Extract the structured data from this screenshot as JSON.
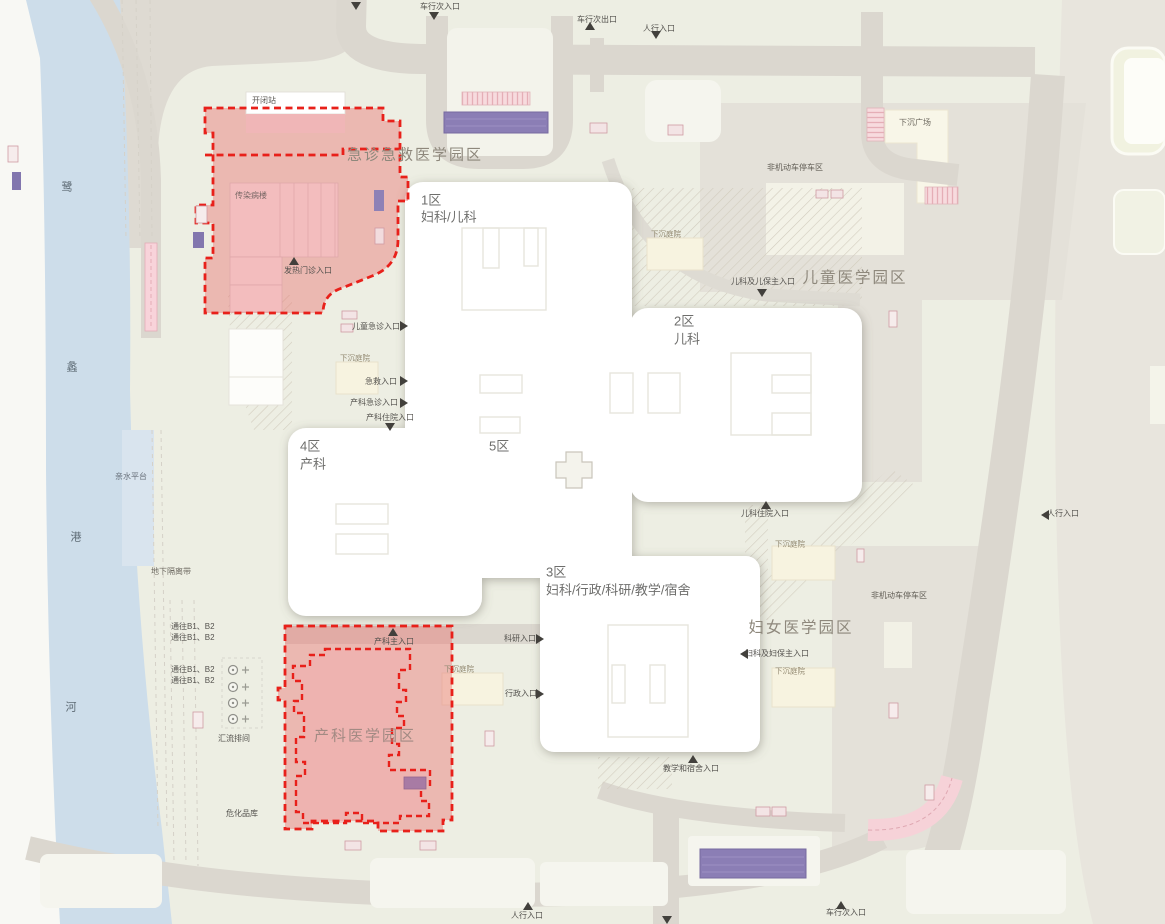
{
  "page": {
    "width": 1165,
    "height": 924,
    "type": "hospital-campus-site-plan"
  },
  "colors": {
    "site_ground": "#edeee3",
    "offsite": "#e8e5dd",
    "road": "#dbd7cf",
    "river": "#cdddea",
    "west_bank": "#f8f8f4",
    "red_zone_fill": "#e96e6c",
    "red_dash": "#e8201a",
    "building_white": "#ffffff",
    "pink_building": "#f3bdbe",
    "purple_ramp": "#8b7eb5",
    "parking": "#e4e1d9",
    "courtyard_box": "#f7f3e0",
    "crosswalk_pink": "#f7dbde"
  },
  "map": {
    "river_name": "鹭蠡港河",
    "campuses": [
      "急诊急救医学园区",
      "儿童医学园区",
      "妇女医学园区",
      "产科医学园区"
    ],
    "districts": [
      {
        "id": "1区",
        "dept": "妇科/儿科"
      },
      {
        "id": "2区",
        "dept": "儿科"
      },
      {
        "id": "3区",
        "dept": "妇科/行政/科研/教学/宿舍"
      },
      {
        "id": "4区",
        "dept": "产科"
      },
      {
        "id": "5区",
        "dept": ""
      }
    ],
    "labels": [
      {
        "n": "label-vehicle-entry-top",
        "t": "车行次入口",
        "x": 440,
        "y": 7,
        "a": "c",
        "s": 8
      },
      {
        "n": "label-vehicle-exit-top",
        "t": "车行次出口",
        "x": 597,
        "y": 20,
        "a": "c",
        "s": 8
      },
      {
        "n": "label-pedestrian-entry-top",
        "t": "人行入口",
        "x": 659,
        "y": 29,
        "a": "c",
        "s": 8
      },
      {
        "n": "label-campus-emergency",
        "t": "急诊急救医学园区",
        "x": 415,
        "y": 155,
        "a": "c",
        "s": 15,
        "c": "#8e887c",
        "ls": 2
      },
      {
        "n": "label-switch-station",
        "t": "开闭站",
        "x": 252,
        "y": 101,
        "a": "l",
        "s": 8,
        "c": "#5c5a56"
      },
      {
        "n": "label-infectious-building",
        "t": "传染病楼",
        "x": 235,
        "y": 196,
        "a": "l",
        "s": 8,
        "c": "#786765"
      },
      {
        "n": "label-fever-clinic-entry",
        "t": "发热门诊入口",
        "x": 308,
        "y": 271,
        "a": "c",
        "s": 8
      },
      {
        "n": "label-district1-no",
        "t": "1区",
        "x": 421,
        "y": 200,
        "a": "l",
        "s": 13,
        "c": "#6e6e6c"
      },
      {
        "n": "label-district1-dept",
        "t": "妇科/儿科",
        "x": 421,
        "y": 217,
        "a": "l",
        "s": 13,
        "c": "#6e6e6c"
      },
      {
        "n": "label-district2-no",
        "t": "2区",
        "x": 674,
        "y": 321,
        "a": "l",
        "s": 13,
        "c": "#6e6e6c"
      },
      {
        "n": "label-district2-dept",
        "t": "儿科",
        "x": 674,
        "y": 339,
        "a": "l",
        "s": 13,
        "c": "#6e6e6c"
      },
      {
        "n": "label-campus-children",
        "t": "儿童医学园区",
        "x": 855,
        "y": 278,
        "a": "c",
        "s": 15.5,
        "c": "#8e887c",
        "ls": 2
      },
      {
        "n": "label-pediatrics-main-entry",
        "t": "儿科及儿保主入口",
        "x": 763,
        "y": 282,
        "a": "c",
        "s": 8
      },
      {
        "n": "label-sunken-courtyard-ne",
        "t": "下沉庭院",
        "x": 651,
        "y": 234,
        "a": "l",
        "s": 7.5,
        "c": "#938a72"
      },
      {
        "n": "label-sunken-plaza",
        "t": "下沉广场",
        "x": 915,
        "y": 123,
        "a": "c",
        "s": 8,
        "c": "#6e6a60"
      },
      {
        "n": "label-parking-top",
        "t": "非机动车停车区",
        "x": 795,
        "y": 168,
        "a": "c",
        "s": 8,
        "c": "#615d55"
      },
      {
        "n": "label-children-emergency-entry",
        "t": "儿童急诊入口",
        "x": 376,
        "y": 327,
        "a": "c",
        "s": 8
      },
      {
        "n": "label-sunken-courtyard-w",
        "t": "下沉庭院",
        "x": 340,
        "y": 358,
        "a": "l",
        "s": 7.5,
        "c": "#938a72"
      },
      {
        "n": "label-rescue-entry",
        "t": "急救入口",
        "x": 381,
        "y": 382,
        "a": "c",
        "s": 8
      },
      {
        "n": "label-obstetrics-emergency-entry",
        "t": "产科急诊入口",
        "x": 374,
        "y": 403,
        "a": "c",
        "s": 8
      },
      {
        "n": "label-obstetrics-inpatient-entry",
        "t": "产科住院入口",
        "x": 390,
        "y": 418,
        "a": "c",
        "s": 8
      },
      {
        "n": "label-district4-no",
        "t": "4区",
        "x": 300,
        "y": 446,
        "a": "l",
        "s": 13,
        "c": "#6e6e6c"
      },
      {
        "n": "label-district4-dept",
        "t": "产科",
        "x": 300,
        "y": 464,
        "a": "l",
        "s": 13,
        "c": "#6e6e6c"
      },
      {
        "n": "label-district5-no",
        "t": "5区",
        "x": 489,
        "y": 446,
        "a": "l",
        "s": 13,
        "c": "#6e6e6c"
      },
      {
        "n": "label-waterfront-platform",
        "t": "亲水平台",
        "x": 131,
        "y": 477,
        "a": "c",
        "s": 8,
        "c": "#68707a"
      },
      {
        "n": "label-underground-isolation",
        "t": "地下隔离带",
        "x": 171,
        "y": 572,
        "a": "c",
        "s": 8,
        "c": "#6e6a62"
      },
      {
        "n": "label-to-b1b2-1",
        "t": "通往B1、B2",
        "x": 171,
        "y": 627,
        "a": "l",
        "s": 8
      },
      {
        "n": "label-to-b1b2-2",
        "t": "通往B1、B2",
        "x": 171,
        "y": 638,
        "a": "l",
        "s": 8
      },
      {
        "n": "label-to-b1b2-3",
        "t": "通往B1、B2",
        "x": 171,
        "y": 670,
        "a": "l",
        "s": 8
      },
      {
        "n": "label-to-b1b2-4",
        "t": "通往B1、B2",
        "x": 171,
        "y": 681,
        "a": "l",
        "s": 8
      },
      {
        "n": "label-busbar-room",
        "t": "汇流排间",
        "x": 234,
        "y": 739,
        "a": "c",
        "s": 8
      },
      {
        "n": "label-hazmat-warehouse",
        "t": "危化品库",
        "x": 242,
        "y": 814,
        "a": "c",
        "s": 8
      },
      {
        "n": "label-district3-no",
        "t": "3区",
        "x": 546,
        "y": 572,
        "a": "l",
        "s": 13,
        "c": "#6e6e6c"
      },
      {
        "n": "label-district3-dept",
        "t": "妇科/行政/科研/教学/宿舍",
        "x": 546,
        "y": 590,
        "a": "l",
        "s": 13,
        "c": "#6e6e6c"
      },
      {
        "n": "label-research-entry",
        "t": "科研入口",
        "x": 520,
        "y": 639,
        "a": "c",
        "s": 8
      },
      {
        "n": "label-admin-entry",
        "t": "行政入口",
        "x": 521,
        "y": 694,
        "a": "c",
        "s": 8
      },
      {
        "n": "label-obstetrics-main-entry",
        "t": "产科主入口",
        "x": 394,
        "y": 642,
        "a": "c",
        "s": 8
      },
      {
        "n": "label-sunken-courtyard-s",
        "t": "下沉庭院",
        "x": 444,
        "y": 669,
        "a": "l",
        "s": 7.5,
        "c": "#938a72"
      },
      {
        "n": "label-campus-obstetrics",
        "t": "产科医学园区",
        "x": 365,
        "y": 736,
        "a": "c",
        "s": 15,
        "c": "#a28a83",
        "ls": 2
      },
      {
        "n": "label-campus-women",
        "t": "妇女医学园区",
        "x": 801,
        "y": 628,
        "a": "c",
        "s": 15.5,
        "c": "#8e887c",
        "ls": 2
      },
      {
        "n": "label-gyn-main-entry",
        "t": "妇科及妇保主入口",
        "x": 777,
        "y": 654,
        "a": "c",
        "s": 8
      },
      {
        "n": "label-sunken-courtyard-e1",
        "t": "下沉庭院",
        "x": 775,
        "y": 544,
        "a": "l",
        "s": 7.5,
        "c": "#938a72"
      },
      {
        "n": "label-sunken-courtyard-e2",
        "t": "下沉庭院",
        "x": 775,
        "y": 671,
        "a": "l",
        "s": 7.5,
        "c": "#938a72"
      },
      {
        "n": "label-pediatric-inpatient-entry",
        "t": "儿科住院入口",
        "x": 765,
        "y": 514,
        "a": "c",
        "s": 8
      },
      {
        "n": "label-parking-right",
        "t": "非机动车停车区",
        "x": 899,
        "y": 596,
        "a": "c",
        "s": 8,
        "c": "#615d55"
      },
      {
        "n": "label-pedestrian-entry-right",
        "t": "人行入口",
        "x": 1063,
        "y": 514,
        "a": "c",
        "s": 8
      },
      {
        "n": "label-teaching-dorm-entry",
        "t": "教学和宿舍入口",
        "x": 691,
        "y": 769,
        "a": "c",
        "s": 8
      },
      {
        "n": "label-pedestrian-entry-bottom",
        "t": "人行入口",
        "x": 527,
        "y": 916,
        "a": "c",
        "s": 8
      },
      {
        "n": "label-vehicle-entry-bottom",
        "t": "车行次入口",
        "x": 846,
        "y": 913,
        "a": "c",
        "s": 8
      },
      {
        "n": "label-river-char-1",
        "t": "鹭",
        "x": 67,
        "y": 188,
        "a": "c",
        "s": 11,
        "c": "#5d6a74"
      },
      {
        "n": "label-river-char-2",
        "t": "蠡",
        "x": 72,
        "y": 368,
        "a": "c",
        "s": 11,
        "c": "#5d6a74"
      },
      {
        "n": "label-river-char-3",
        "t": "港",
        "x": 76,
        "y": 538,
        "a": "c",
        "s": 11,
        "c": "#5d6a74"
      },
      {
        "n": "label-river-char-4",
        "t": "河",
        "x": 71,
        "y": 708,
        "a": "c",
        "s": 11,
        "c": "#5d6a74"
      }
    ],
    "arrows": [
      {
        "n": "entrance-arrow",
        "d": "down",
        "x": 356,
        "y": 6
      },
      {
        "n": "entrance-arrow",
        "d": "down",
        "x": 434,
        "y": 16
      },
      {
        "n": "entrance-arrow",
        "d": "up",
        "x": 590,
        "y": 26
      },
      {
        "n": "entrance-arrow",
        "d": "down",
        "x": 656,
        "y": 35
      },
      {
        "n": "entrance-arrow",
        "d": "up",
        "x": 294,
        "y": 261
      },
      {
        "n": "entrance-arrow",
        "d": "right",
        "x": 404,
        "y": 326
      },
      {
        "n": "entrance-arrow",
        "d": "right",
        "x": 404,
        "y": 381
      },
      {
        "n": "entrance-arrow",
        "d": "right",
        "x": 404,
        "y": 403
      },
      {
        "n": "entrance-arrow",
        "d": "down",
        "x": 390,
        "y": 427
      },
      {
        "n": "entrance-arrow",
        "d": "down",
        "x": 762,
        "y": 293
      },
      {
        "n": "entrance-arrow",
        "d": "up",
        "x": 766,
        "y": 505
      },
      {
        "n": "entrance-arrow",
        "d": "left",
        "x": 744,
        "y": 654
      },
      {
        "n": "entrance-arrow",
        "d": "left",
        "x": 1045,
        "y": 515
      },
      {
        "n": "entrance-arrow",
        "d": "up",
        "x": 393,
        "y": 632
      },
      {
        "n": "entrance-arrow",
        "d": "right",
        "x": 540,
        "y": 639
      },
      {
        "n": "entrance-arrow",
        "d": "right",
        "x": 540,
        "y": 694
      },
      {
        "n": "entrance-arrow",
        "d": "up",
        "x": 693,
        "y": 759
      },
      {
        "n": "entrance-arrow",
        "d": "up",
        "x": 528,
        "y": 906
      },
      {
        "n": "entrance-arrow",
        "d": "down",
        "x": 667,
        "y": 920
      },
      {
        "n": "entrance-arrow",
        "d": "up",
        "x": 841,
        "y": 905
      }
    ]
  }
}
